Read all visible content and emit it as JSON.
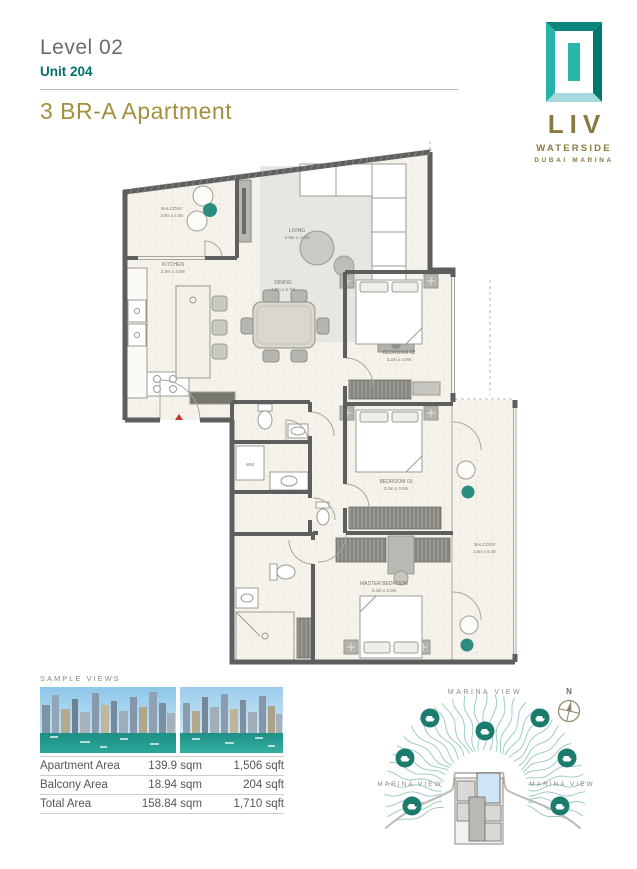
{
  "header": {
    "level": "Level 02",
    "unit": "Unit 204",
    "title": "3 BR-A Apartment"
  },
  "logo": {
    "name": "LIV",
    "line1": "WATERSIDE",
    "line2": "DUBAI MARINA"
  },
  "floorplan": {
    "rooms": {
      "balcony_tl": {
        "name": "BALCONY",
        "dims": "3.0m x 2.0m"
      },
      "kitchen": {
        "name": "KITCHEN",
        "dims": "2.3m x 3.5m"
      },
      "living": {
        "name": "LIVING",
        "dims": "4.9m x 4.5m"
      },
      "dining": {
        "name": "DINING",
        "dims": "4.8m x 4.7m"
      },
      "bedroom02": {
        "name": "BEDROOM 02",
        "dims": "3.2m x 3.9m"
      },
      "bedroom03": {
        "name": "BEDROOM 03",
        "dims": "3.2m x 3.9m"
      },
      "master": {
        "name": "MASTER BEDROOM",
        "dims": "4.4m x 4.0m"
      },
      "balcony_r": {
        "name": "BALCONY",
        "dims": "1.5m x 8.4m"
      }
    },
    "wm_label": "WM"
  },
  "sample_views": {
    "label": "SAMPLE VIEWS"
  },
  "area_table": {
    "rows": [
      {
        "label": "Apartment Area",
        "sqm": "139.9 sqm",
        "sqft": "1,506 sqft"
      },
      {
        "label": "Balcony Area",
        "sqm": "18.94 sqm",
        "sqft": "204 sqft"
      },
      {
        "label": "Total Area",
        "sqm": "158.84 sqm",
        "sqft": "1,710 sqft"
      }
    ]
  },
  "marina": {
    "label_top": "MARINA VIEW",
    "label_left": "MARINA VIEW",
    "label_right": "MARINA VIEW",
    "compass_n": "N"
  },
  "colors": {
    "teal": "#00716b",
    "gold": "#a2903f",
    "logo_gold": "#8a7a42",
    "wall_gray": "#5e5e5e",
    "floor_cream": "#f5f2eb",
    "accent_teal": "#2c8c7f",
    "marina_wave": "#6fb5ab",
    "boat_circle": "#1b7c6e",
    "entry_marker_red": "#c0392b"
  }
}
